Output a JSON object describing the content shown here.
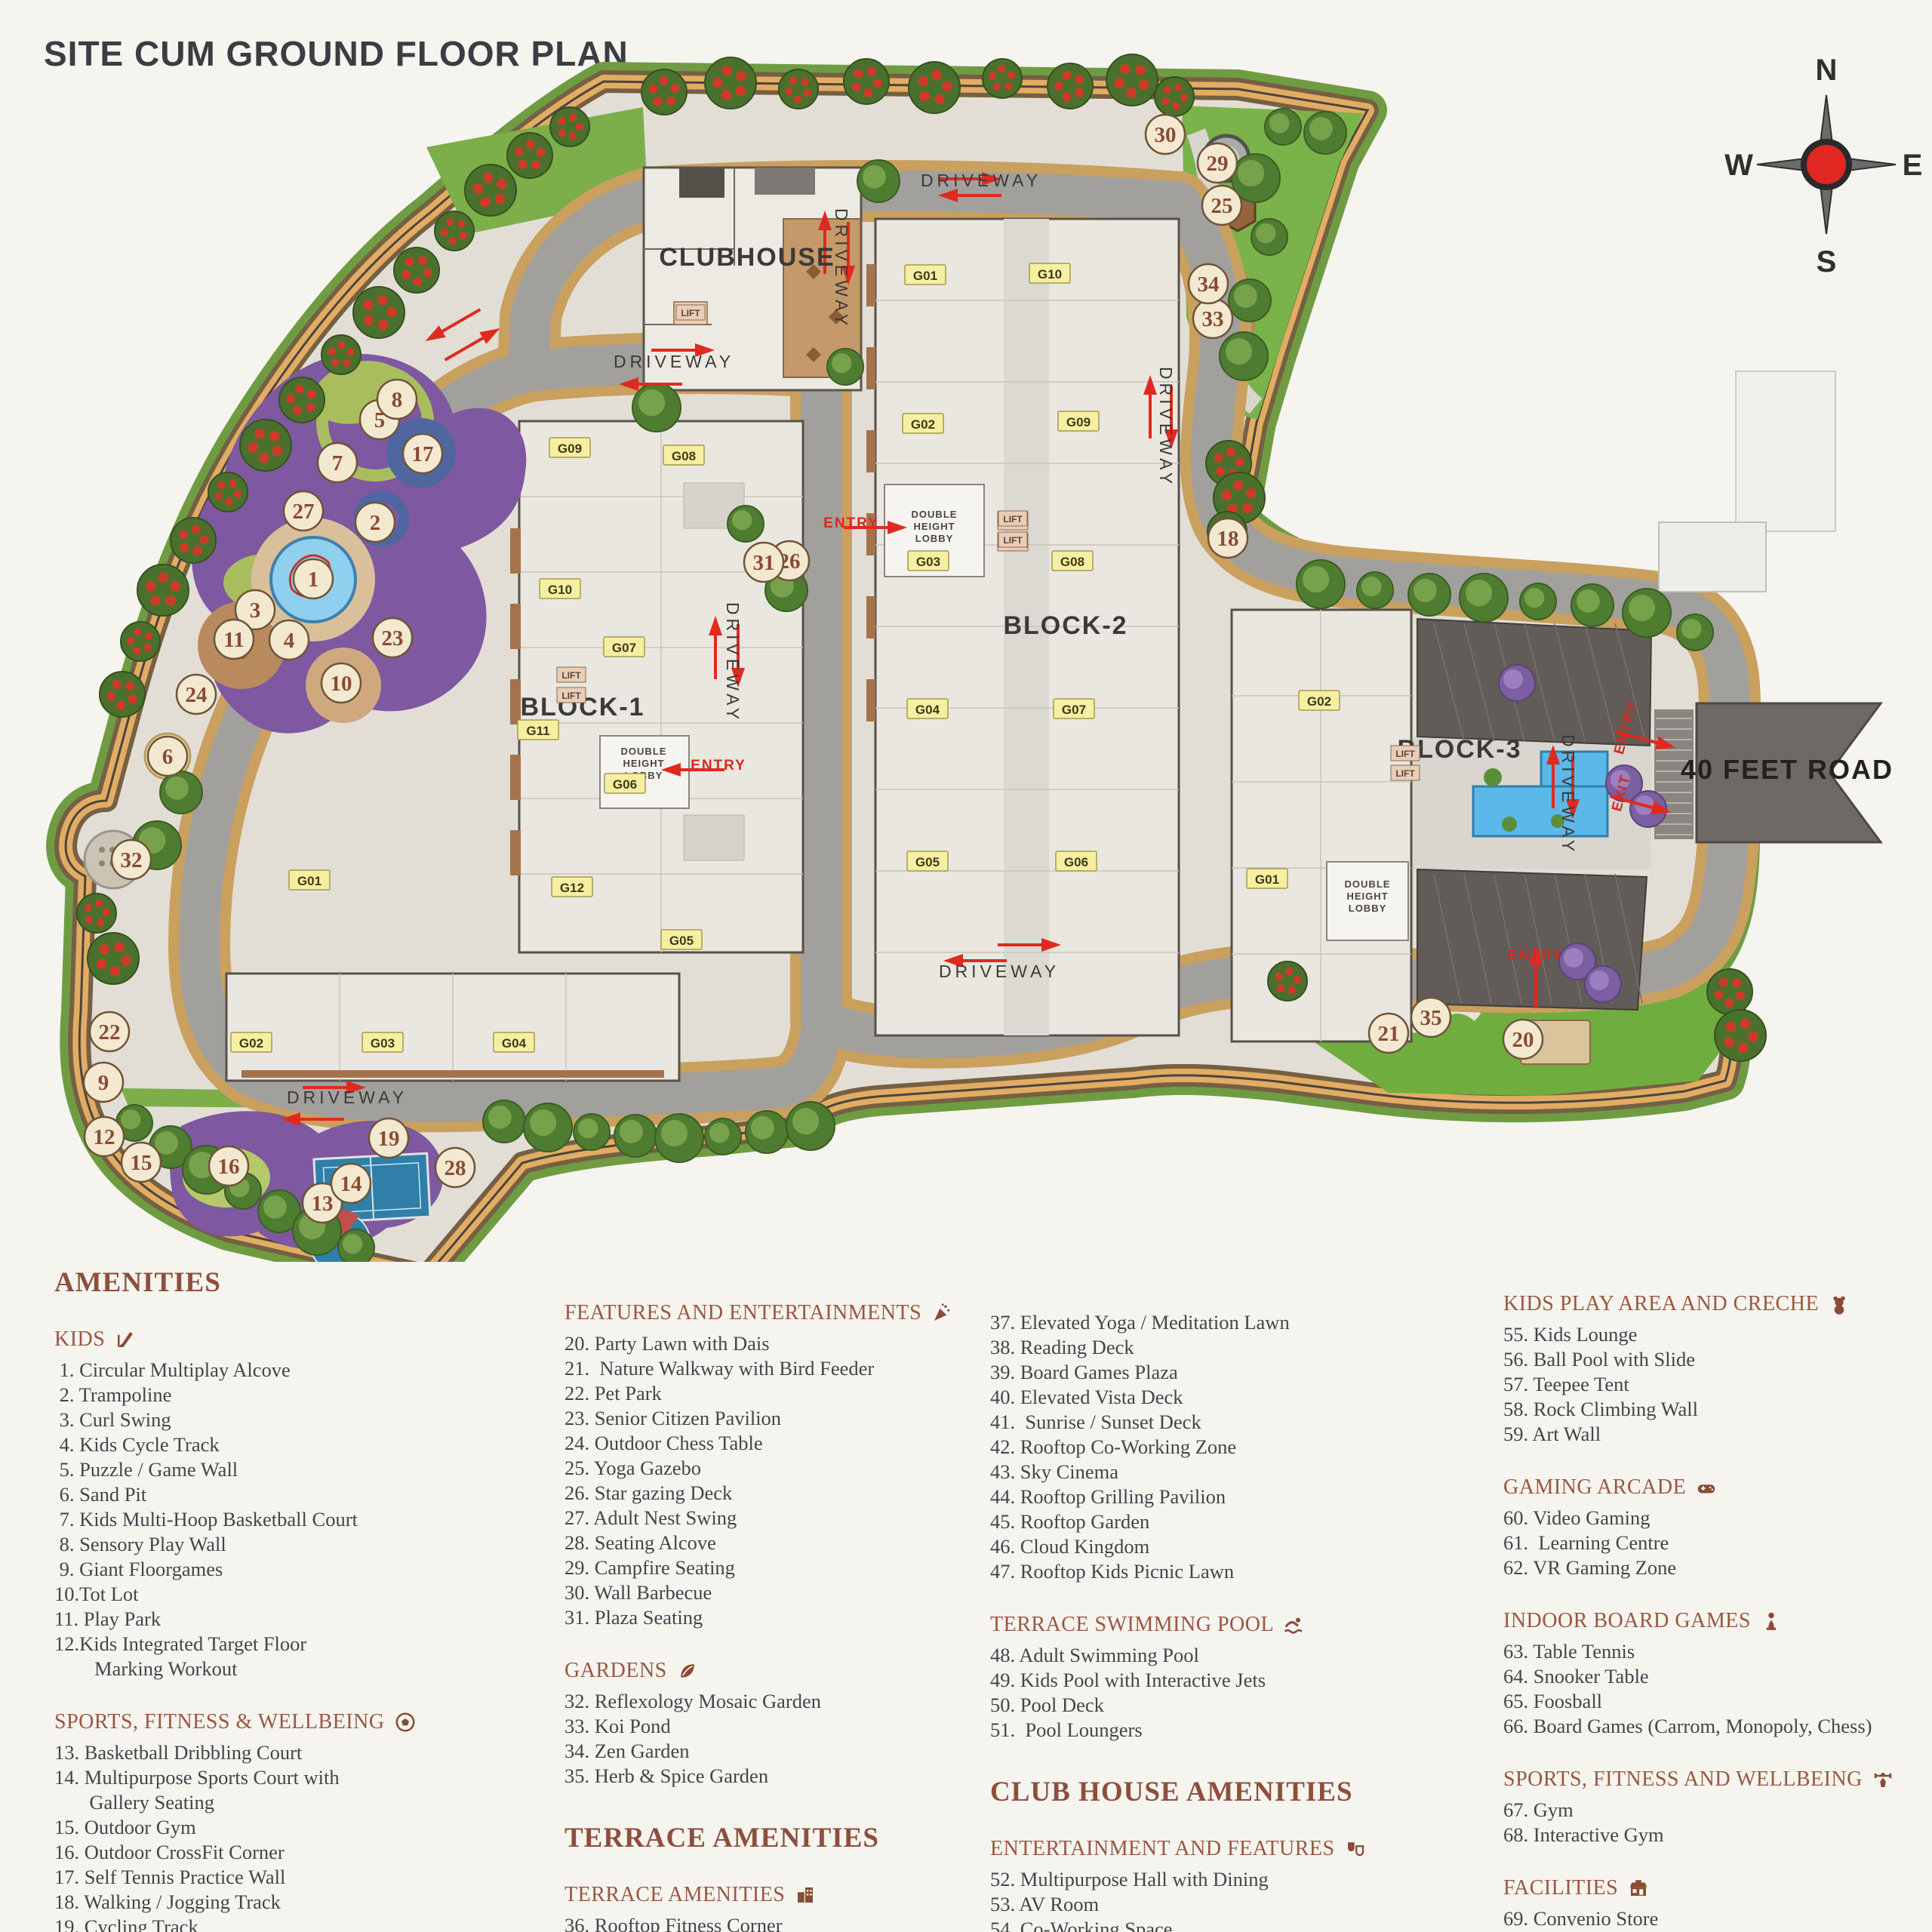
{
  "title": "SITE CUM GROUND FLOOR PLAN",
  "compass": {
    "n": "N",
    "e": "E",
    "s": "S",
    "w": "W"
  },
  "map": {
    "clubhouse_label": [
      "CLUBHOUSE",
      990,
      352
    ],
    "road40_label": [
      "40 FEET ROAD",
      2368,
      1032
    ],
    "block_labels": [
      [
        "BLOCK-1",
        772,
        948
      ],
      [
        "BLOCK-2",
        1412,
        840
      ],
      [
        "BLOCK-3",
        1934,
        1004
      ]
    ],
    "lobby": {
      "lines": [
        "DOUBLE",
        "HEIGHT",
        "LOBBY"
      ],
      "positions": [
        [
          853,
          1000
        ],
        [
          1238,
          686
        ],
        [
          1812,
          1176
        ]
      ]
    },
    "lift": {
      "label": "LIFT",
      "positions": [
        [
          915,
          417
        ],
        [
          757,
          897
        ],
        [
          757,
          924
        ],
        [
          1342,
          690
        ],
        [
          1342,
          718
        ],
        [
          1862,
          1001
        ],
        [
          1862,
          1027
        ]
      ]
    },
    "driveway": {
      "label": "DRIVEWAY",
      "positions": [
        [
          1300,
          247,
          0
        ],
        [
          893,
          487,
          0
        ],
        [
          1107,
          356,
          90
        ],
        [
          963,
          878,
          90
        ],
        [
          1537,
          566,
          90
        ],
        [
          2070,
          1053,
          90
        ],
        [
          460,
          1462,
          0
        ],
        [
          1324,
          1295,
          0
        ]
      ]
    },
    "entries": [
      [
        "ENTRY",
        1128,
        699,
        0
      ],
      [
        "ENTRY",
        952,
        1020,
        0
      ],
      [
        "ENTRY",
        2160,
        965,
        -75
      ],
      [
        "EXIT",
        2154,
        1052,
        -75
      ],
      [
        "ENTRY",
        2035,
        1272,
        0
      ]
    ],
    "units": [
      [
        "G09",
        755,
        594
      ],
      [
        "G08",
        906,
        604
      ],
      [
        "G10",
        742,
        781
      ],
      [
        "G07",
        827,
        858
      ],
      [
        "G11",
        713,
        968
      ],
      [
        "G06",
        828,
        1039
      ],
      [
        "G12",
        758,
        1176
      ],
      [
        "G05",
        903,
        1246
      ],
      [
        "G01",
        410,
        1167
      ],
      [
        "G02",
        333,
        1382
      ],
      [
        "G03",
        507,
        1382
      ],
      [
        "G04",
        681,
        1382
      ],
      [
        "G01",
        1226,
        365
      ],
      [
        "G10",
        1391,
        363
      ],
      [
        "G02",
        1223,
        562
      ],
      [
        "G09",
        1429,
        559
      ],
      [
        "G03",
        1230,
        744
      ],
      [
        "G08",
        1421,
        744
      ],
      [
        "G04",
        1229,
        940
      ],
      [
        "G07",
        1423,
        940
      ],
      [
        "G05",
        1229,
        1142
      ],
      [
        "G06",
        1426,
        1142
      ],
      [
        "G02",
        1748,
        929
      ],
      [
        "G01",
        1679,
        1165
      ]
    ],
    "markers": [
      [
        1,
        415,
        767
      ],
      [
        2,
        497,
        692
      ],
      [
        3,
        338,
        808
      ],
      [
        4,
        383,
        848
      ],
      [
        5,
        503,
        556
      ],
      [
        6,
        222,
        1002
      ],
      [
        7,
        447,
        613
      ],
      [
        8,
        526,
        529
      ],
      [
        9,
        137,
        1434
      ],
      [
        10,
        452,
        905
      ],
      [
        11,
        310,
        847
      ],
      [
        12,
        138,
        1506
      ],
      [
        13,
        427,
        1594
      ],
      [
        14,
        465,
        1568
      ],
      [
        15,
        187,
        1540
      ],
      [
        16,
        303,
        1545
      ],
      [
        17,
        560,
        601
      ],
      [
        18,
        1627,
        713
      ],
      [
        19,
        515,
        1508
      ],
      [
        20,
        2018,
        1377
      ],
      [
        21,
        1840,
        1369
      ],
      [
        22,
        145,
        1367
      ],
      [
        23,
        520,
        845
      ],
      [
        24,
        260,
        920
      ],
      [
        25,
        1619,
        272
      ],
      [
        26,
        1046,
        743
      ],
      [
        27,
        402,
        677
      ],
      [
        28,
        603,
        1547
      ],
      [
        29,
        1613,
        216
      ],
      [
        30,
        1544,
        178
      ],
      [
        31,
        1012,
        745
      ],
      [
        32,
        174,
        1139
      ],
      [
        33,
        1607,
        422
      ],
      [
        34,
        1601,
        376
      ],
      [
        35,
        1896,
        1348
      ]
    ]
  },
  "legend": {
    "columns": [
      {
        "blocks": [
          {
            "type": "title",
            "text": "AMENITIES"
          },
          {
            "type": "section",
            "header": "KIDS",
            "icon": "slide-icon",
            "items": [
              " 1. Circular Multiplay Alcove",
              " 2. Trampoline",
              " 3. Curl Swing",
              " 4. Kids Cycle Track",
              " 5. Puzzle / Game Wall",
              " 6. Sand Pit",
              " 7. Kids Multi-Hoop Basketball Court",
              " 8. Sensory Play Wall",
              " 9. Giant Floorgames",
              "10.Tot Lot",
              "11. Play Park",
              "12.Kids Integrated Target Floor",
              "        Marking Workout"
            ]
          },
          {
            "type": "section",
            "header": "SPORTS, FITNESS & WELLBEING",
            "icon": "soccer-icon",
            "items": [
              "13. Basketball Dribbling Court",
              "14. Multipurpose Sports Court with",
              "       Gallery Seating",
              "15. Outdoor Gym",
              "16. Outdoor CrossFit Corner",
              "17. Self Tennis Practice Wall",
              "18. Walking / Jogging Track",
              "19. Cycling Track"
            ]
          }
        ]
      },
      {
        "blocks": [
          {
            "type": "section",
            "header": "FEATURES AND ENTERTAINMENTS",
            "icon": "party-icon",
            "items": [
              "20. Party Lawn with Dais",
              "21.  Nature Walkway with Bird Feeder",
              "22. Pet Park",
              "23. Senior Citizen Pavilion",
              "24. Outdoor Chess Table",
              "25. Yoga Gazebo",
              "26. Star gazing Deck",
              "27. Adult Nest Swing",
              "28. Seating Alcove",
              "29. Campfire Seating",
              "30. Wall Barbecue",
              "31. Plaza Seating"
            ]
          },
          {
            "type": "section",
            "header": "GARDENS",
            "icon": "leaf-icon",
            "items": [
              "32. Reflexology Mosaic Garden",
              "33. Koi Pond",
              "34. Zen Garden",
              "35. Herb & Spice Garden"
            ]
          },
          {
            "type": "title",
            "text": "TERRACE AMENITIES"
          },
          {
            "type": "section",
            "header": "TERRACE AMENITIES",
            "icon": "building-icon",
            "items": [
              "36. Rooftop Fitness Corner"
            ]
          }
        ]
      },
      {
        "blocks": [
          {
            "type": "section",
            "header": "",
            "icon": "",
            "items": [
              "37. Elevated Yoga / Meditation Lawn",
              "38. Reading Deck",
              "39. Board Games Plaza",
              "40. Elevated Vista Deck",
              "41.  Sunrise / Sunset Deck",
              "42. Rooftop Co-Working Zone",
              "43. Sky Cinema",
              "44. Rooftop Grilling Pavilion",
              "45. Rooftop Garden",
              "46. Cloud Kingdom",
              "47. Rooftop Kids Picnic Lawn"
            ]
          },
          {
            "type": "section",
            "header": "TERRACE SWIMMING POOL",
            "icon": "swimmer-icon",
            "items": [
              "48. Adult Swimming Pool",
              "49. Kids Pool with Interactive Jets",
              "50. Pool Deck",
              "51.  Pool Loungers"
            ]
          },
          {
            "type": "title",
            "text": "CLUB HOUSE AMENITIES"
          },
          {
            "type": "section",
            "header": "ENTERTAINMENT AND FEATURES",
            "icon": "masks-icon",
            "items": [
              "52. Multipurpose Hall with Dining",
              "53. AV Room",
              "54. Co-Working Space"
            ]
          }
        ]
      },
      {
        "blocks": [
          {
            "type": "section",
            "header": "KIDS PLAY AREA AND CRECHE",
            "icon": "teddy-icon",
            "items": [
              "55. Kids Lounge",
              "56. Ball Pool with Slide",
              "57. Teepee Tent",
              "58. Rock Climbing Wall",
              "59. Art Wall"
            ]
          },
          {
            "type": "section",
            "header": "GAMING ARCADE",
            "icon": "gamepad-icon",
            "items": [
              "60. Video Gaming",
              "61.  Learning Centre",
              "62. VR Gaming Zone"
            ]
          },
          {
            "type": "section",
            "header": "INDOOR BOARD GAMES",
            "icon": "pawn-icon",
            "items": [
              "63. Table Tennis",
              "64. Snooker Table",
              "65. Foosball",
              "66. Board Games (Carrom, Monopoly, Chess)"
            ]
          },
          {
            "type": "section",
            "header": "SPORTS, FITNESS AND WELLBEING",
            "icon": "lifter-icon",
            "items": [
              "67. Gym",
              "68. Interactive Gym"
            ]
          },
          {
            "type": "section",
            "header": "FACILITIES",
            "icon": "store-icon",
            "items": [
              "69. Convenio Store",
              "70. Coffee Station"
            ]
          }
        ]
      }
    ]
  },
  "colors": {
    "accent_header": "#9a5741",
    "item_text": "#41464b",
    "marker_fill": "#f3e9d1",
    "marker_text": "#8a4a35",
    "road": "#a2a09c",
    "walkway": "#e2ab62",
    "lawn": "#6fae3e",
    "play_purple": "#7e58a0",
    "pool_blue": "#5bb8e8",
    "road40": "#6e6965",
    "arrow_red": "#e02a1f",
    "unit_chip": "#f6efa2"
  }
}
